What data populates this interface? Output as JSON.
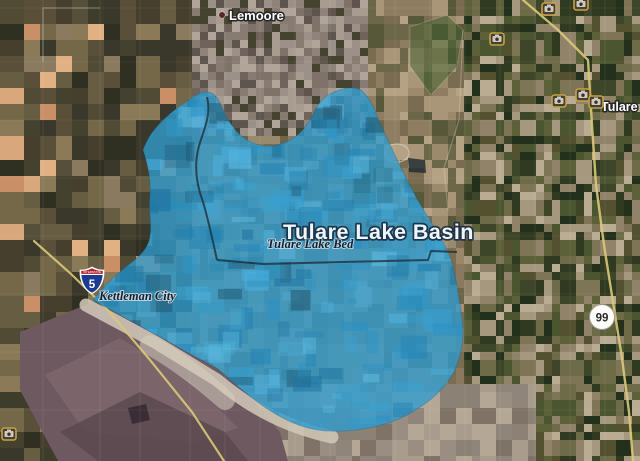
{
  "app": {
    "type": "satellite-map-view"
  },
  "labels": {
    "city_top": "Lemoore",
    "city_right": "Tulare",
    "city_left": "Kettleman City",
    "region_title": "Tulare Lake Basin",
    "region_subtitle": "Tulare Lake Bed"
  },
  "shields": {
    "interstate_number": "5",
    "interstate_caption": "INTERSTATE",
    "state_route_number": "99"
  },
  "icons": {
    "photo_marker": "camera-icon",
    "photo_marker_count": 7,
    "city_marker": "dot-icon"
  },
  "overlay": {
    "fill_color": "#2F9CCF"
  },
  "colors": {
    "overlay_blue": "#2F9CCF",
    "road_yellow": "#D9C878",
    "shield_blue": "#1A3B8F",
    "shield_red": "#AE2330",
    "hills_purple": "#6E5961",
    "route_badge_bg": "#FCFCF9"
  }
}
